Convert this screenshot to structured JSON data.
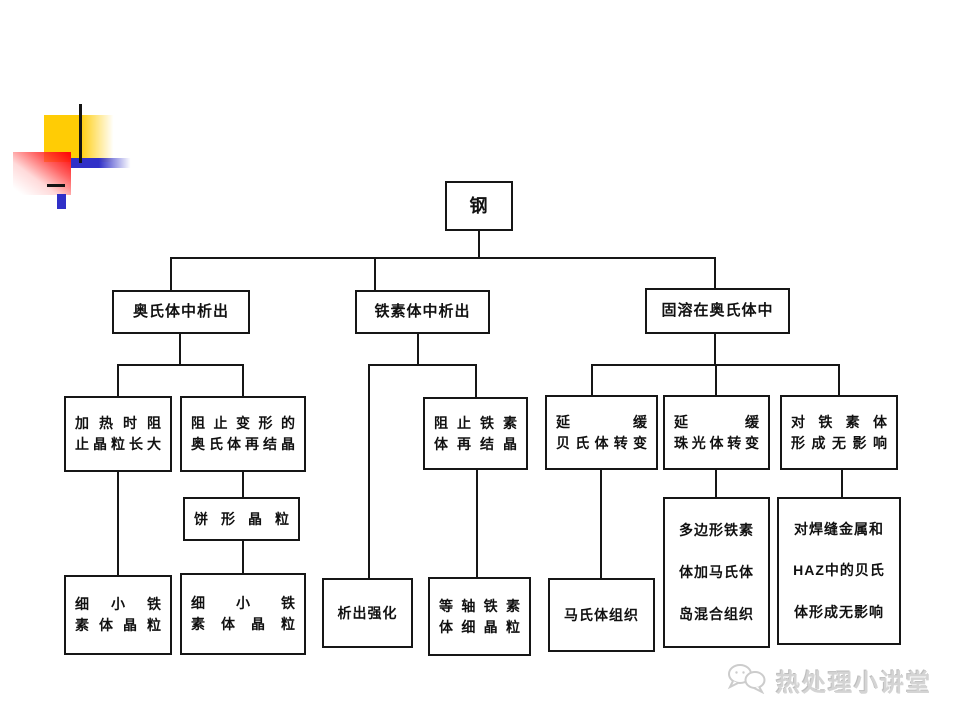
{
  "diagram": {
    "root_label": "钢",
    "l2": [
      {
        "label": "奥氏体中析出"
      },
      {
        "label": "铁素体中析出"
      },
      {
        "label": "固溶在奥氏体中"
      }
    ],
    "nodes": {
      "heat_block_growth": [
        "加热时阻",
        "止晶粒长大"
      ],
      "deform_recryst": [
        "阻止变形的",
        "奥氏体再结晶"
      ],
      "pancake_grain": [
        "饼形晶粒"
      ],
      "fine_ferrite_1": [
        "细小铁",
        "素体晶粒"
      ],
      "fine_ferrite_2": [
        "细小铁",
        "素体晶粒"
      ],
      "ferrite_recryst": [
        "阻止铁素",
        "体再结晶"
      ],
      "precip_strength": [
        "析出强化"
      ],
      "equiaxed_fine": [
        "等轴铁素",
        "体细晶粒"
      ],
      "delay_bainite": [
        "延缓",
        "贝氏体转变"
      ],
      "delay_pearlite": [
        "延缓",
        "珠光体转变"
      ],
      "no_effect_ferrite": [
        "对铁素体",
        "形成无影响"
      ],
      "martensite": [
        "马氏体组织"
      ],
      "polygonal_mix": [
        "多边形铁素",
        "体加马氏体",
        "岛混合组织"
      ],
      "weld_haz": [
        "对焊缝金属和",
        "HAZ中的贝氏",
        "体形成无影响"
      ]
    }
  },
  "watermark": {
    "label": "热处理小讲堂",
    "logo": "wechat-icon"
  },
  "colors": {
    "deco_yellow": "#ffcc05",
    "deco_red": "#ff0b0b",
    "deco_blue": "#3030c8",
    "line_black": "#161616",
    "watermark_gray": "#d4d4d4",
    "background": "#ffffff"
  }
}
